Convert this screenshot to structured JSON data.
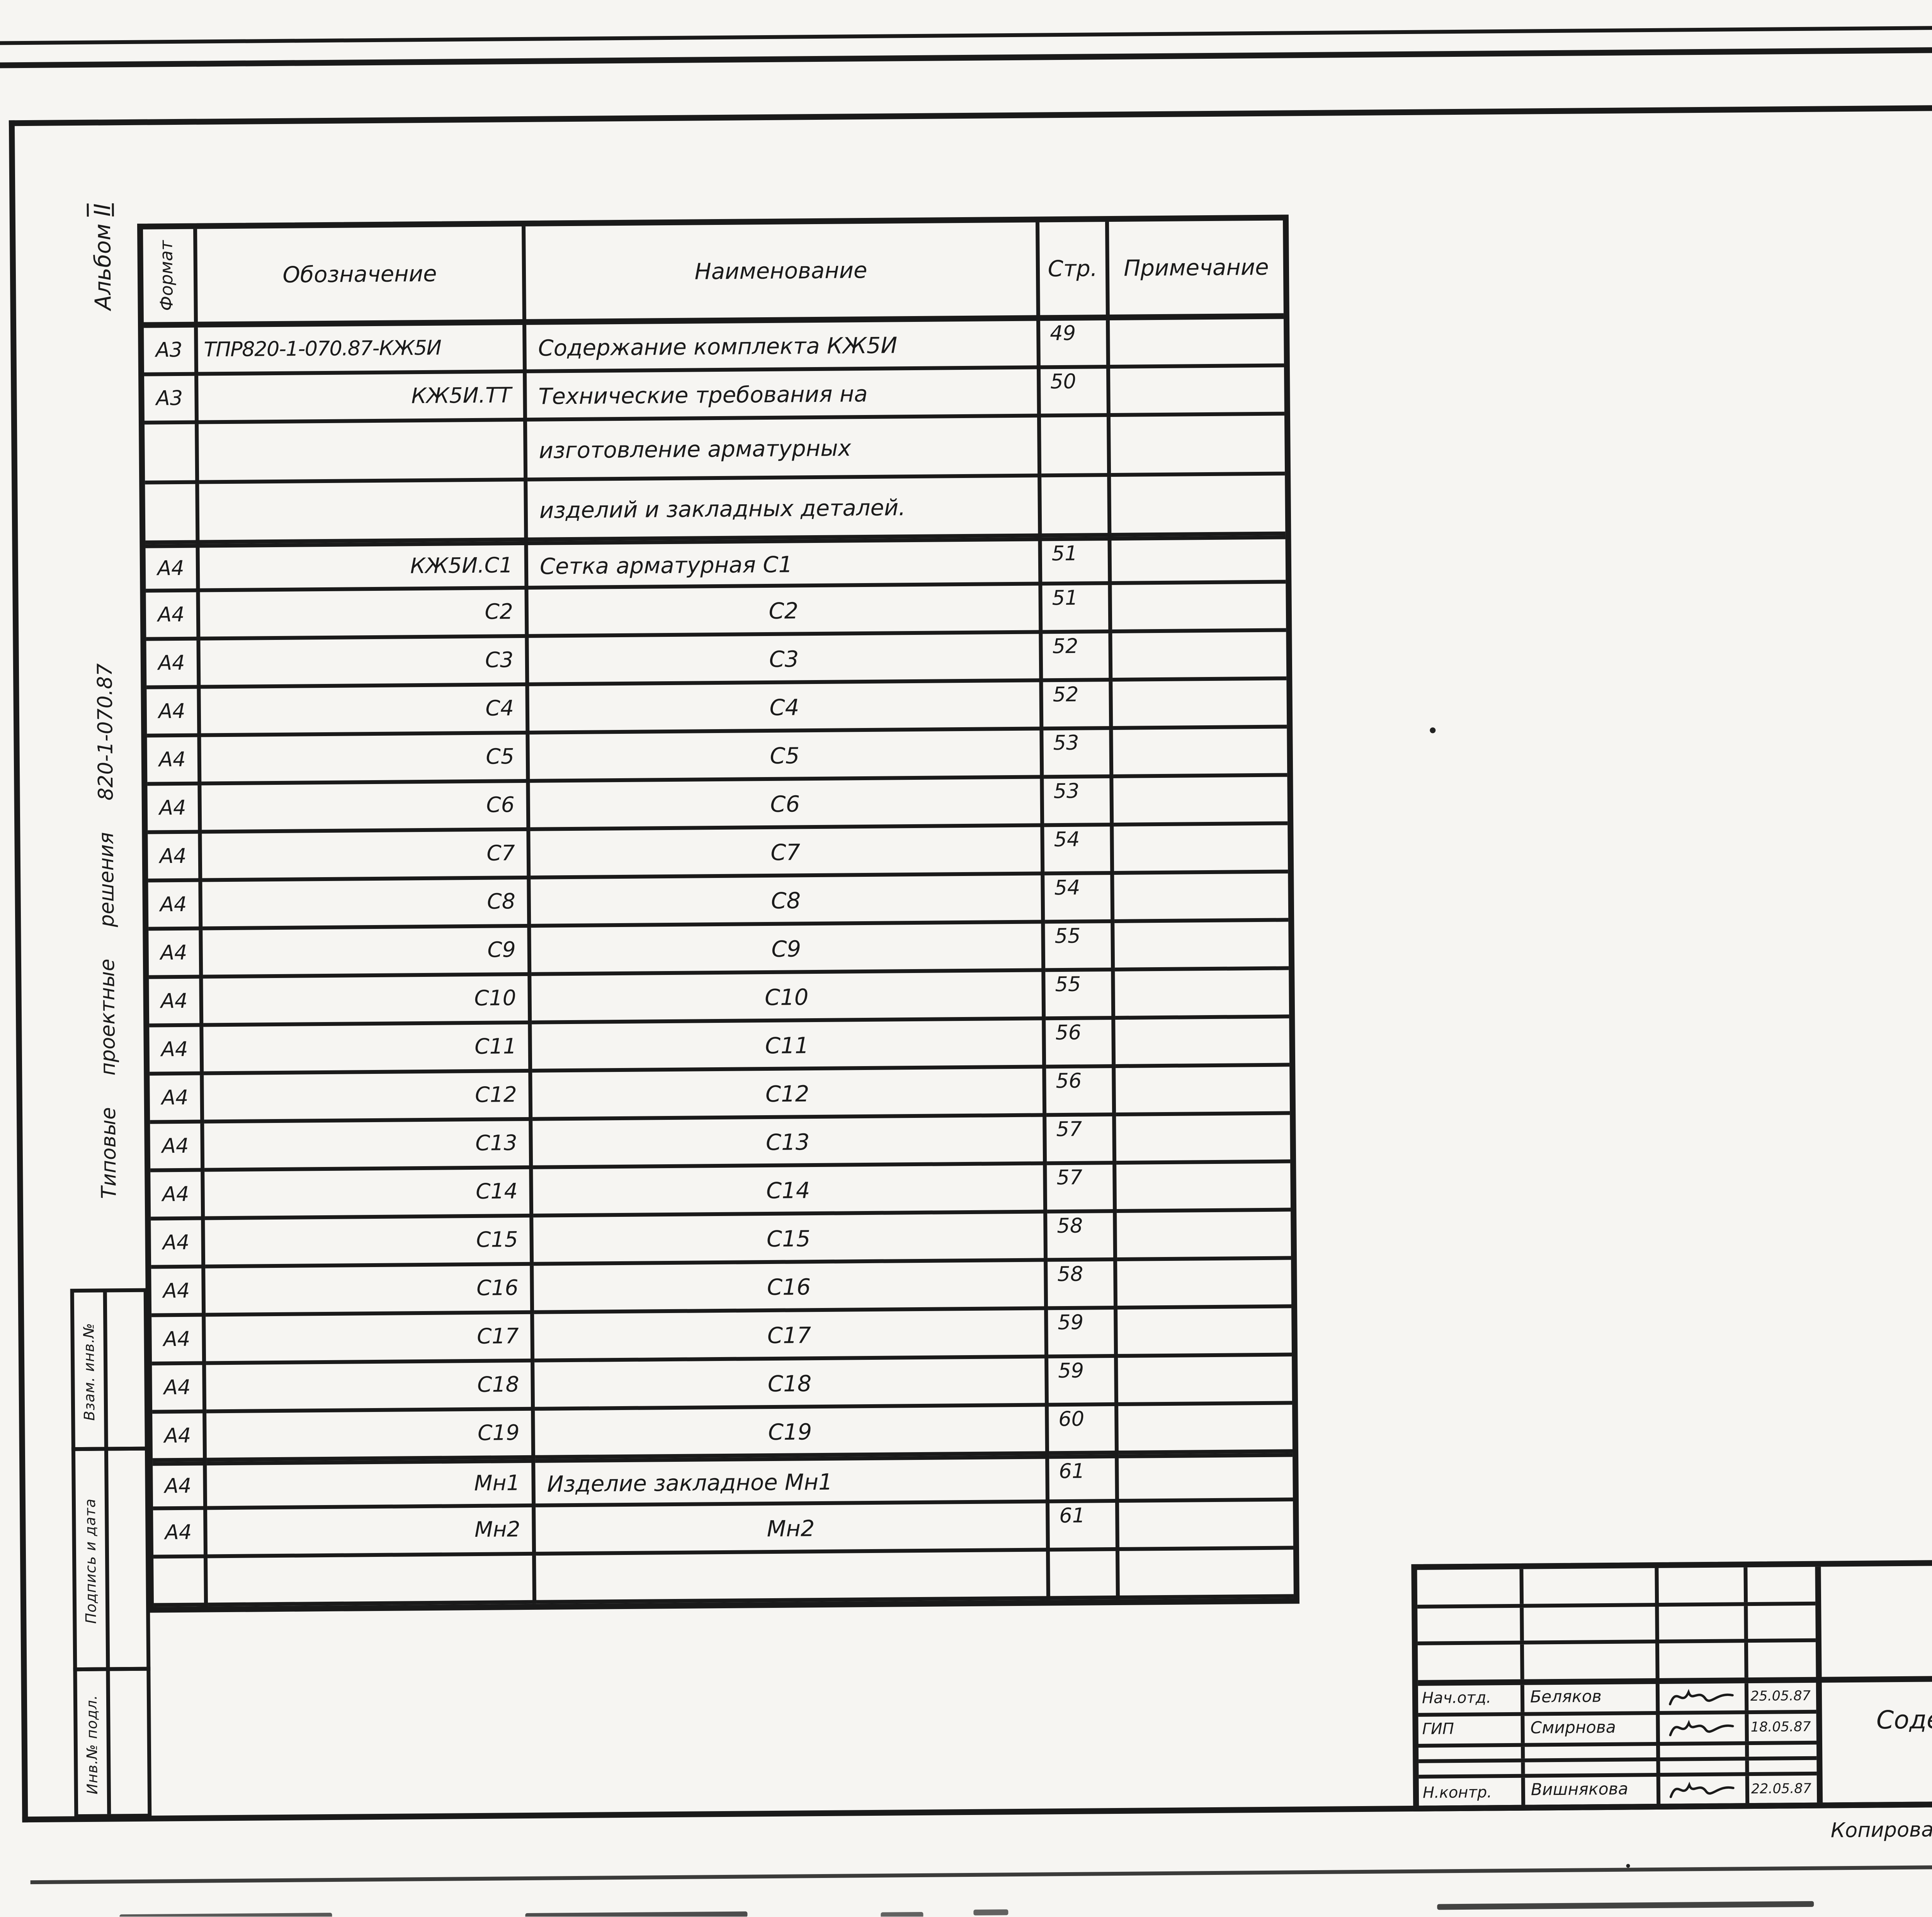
{
  "corner": {
    "page_number": "49"
  },
  "margin": {
    "album_word": "Альбом",
    "album_roman": "II",
    "series": "Типовые  проектные  решения  820-1-070.87",
    "side_stamps": [
      "Взам. инв.№",
      "Подпись и дата",
      "Инв.№ подл."
    ]
  },
  "annotations": {
    "handwritten_number": "2284/2",
    "copied_label": "Копировал",
    "format_note": "Формат А3"
  },
  "binding_block": {
    "title": "Привязан",
    "inv_label": "Инв.№"
  },
  "table": {
    "headers": {
      "format": "Формат",
      "designation": "Обозначение",
      "name": "Наименование",
      "page": "Стр.",
      "note": "Примечание"
    },
    "rows": [
      {
        "format": "А3",
        "designation": "ТПР820-1-070.87-КЖ5И",
        "name": "Содержание комплекта КЖ5И",
        "page": "49",
        "note": ""
      },
      {
        "format": "А3",
        "designation": "КЖ5И.ТТ",
        "name": "Технические требования на",
        "page": "50",
        "note": ""
      },
      {
        "format": "",
        "designation": "",
        "name": "изготовление арматурных",
        "page": "",
        "note": ""
      },
      {
        "format": "",
        "designation": "",
        "name": "изделий и закладных деталей.",
        "page": "",
        "note": ""
      },
      {
        "format": "А4",
        "designation": "КЖ5И.С1",
        "name": "Сетка арматурная С1",
        "page": "51",
        "note": ""
      },
      {
        "format": "А4",
        "designation": "С2",
        "name": "С2",
        "page": "51",
        "note": ""
      },
      {
        "format": "А4",
        "designation": "С3",
        "name": "С3",
        "page": "52",
        "note": ""
      },
      {
        "format": "А4",
        "designation": "С4",
        "name": "С4",
        "page": "52",
        "note": ""
      },
      {
        "format": "А4",
        "designation": "С5",
        "name": "С5",
        "page": "53",
        "note": ""
      },
      {
        "format": "А4",
        "designation": "С6",
        "name": "С6",
        "page": "53",
        "note": ""
      },
      {
        "format": "А4",
        "designation": "С7",
        "name": "С7",
        "page": "54",
        "note": ""
      },
      {
        "format": "А4",
        "designation": "С8",
        "name": "С8",
        "page": "54",
        "note": ""
      },
      {
        "format": "А4",
        "designation": "С9",
        "name": "С9",
        "page": "55",
        "note": ""
      },
      {
        "format": "А4",
        "designation": "С10",
        "name": "С10",
        "page": "55",
        "note": ""
      },
      {
        "format": "А4",
        "designation": "С11",
        "name": "С11",
        "page": "56",
        "note": ""
      },
      {
        "format": "А4",
        "designation": "С12",
        "name": "С12",
        "page": "56",
        "note": ""
      },
      {
        "format": "А4",
        "designation": "С13",
        "name": "С13",
        "page": "57",
        "note": ""
      },
      {
        "format": "А4",
        "designation": "С14",
        "name": "С14",
        "page": "57",
        "note": ""
      },
      {
        "format": "А4",
        "designation": "С15",
        "name": "С15",
        "page": "58",
        "note": ""
      },
      {
        "format": "А4",
        "designation": "С16",
        "name": "С16",
        "page": "58",
        "note": ""
      },
      {
        "format": "А4",
        "designation": "С17",
        "name": "С17",
        "page": "59",
        "note": ""
      },
      {
        "format": "А4",
        "designation": "С18",
        "name": "С18",
        "page": "59",
        "note": ""
      },
      {
        "format": "А4",
        "designation": "С19",
        "name": "С19",
        "page": "60",
        "note": ""
      },
      {
        "format": "А4",
        "designation": "Мн1",
        "name": "Изделие закладное Мн1",
        "page": "61",
        "note": ""
      },
      {
        "format": "А4",
        "designation": "Мн2",
        "name": "Мн2",
        "page": "61",
        "note": ""
      },
      {
        "format": "",
        "designation": "",
        "name": "",
        "page": "",
        "note": ""
      }
    ]
  },
  "stamp": {
    "designation": "ТПР820-1-070.87",
    "designation_suffix": "-КЖ5И",
    "title_line1": "Содержание комплекта",
    "title_line2": "КЖ5И",
    "stage_label": "Стадия",
    "sheet_label": "Лист",
    "sheets_label": "Листов",
    "stage_value": "Р",
    "sheet_value": "1",
    "sheets_value": "",
    "organization": "Ленгипроводхоз",
    "signature_rows": [
      {
        "role": "Нач.отд.",
        "name": "Беляков",
        "date": "25.05.87"
      },
      {
        "role": "ГИП",
        "name": "Смирнова",
        "date": "18.05.87"
      },
      {
        "role": "",
        "name": "",
        "date": ""
      },
      {
        "role": "",
        "name": "",
        "date": ""
      },
      {
        "role": "Н.контр.",
        "name": "Вишнякова",
        "date": "22.05.87"
      }
    ]
  }
}
